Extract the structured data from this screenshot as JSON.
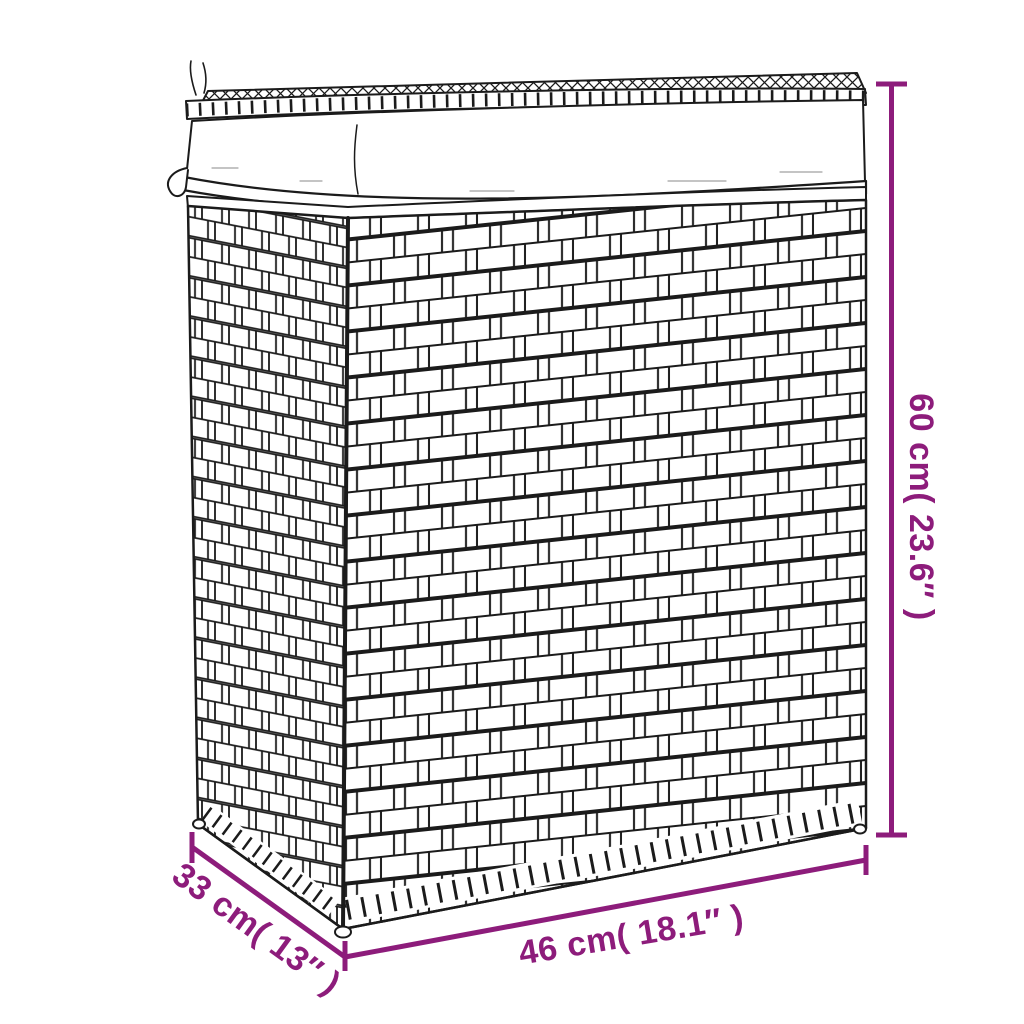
{
  "colors": {
    "accent": "#8d1c7b",
    "line_art": "#1b1b1b",
    "background": "#ffffff"
  },
  "drawing": {
    "subject": "laundry-basket-line-drawing"
  },
  "dimensions": {
    "height": {
      "label": "60 cm( 23.6″ )",
      "value_cm": 60,
      "value_inch": 23.6
    },
    "width": {
      "label": "46 cm( 18.1″ )",
      "value_cm": 46,
      "value_inch": 18.1
    },
    "depth": {
      "label": "33 cm( 13″ )",
      "value_cm": 33,
      "value_inch": 13
    }
  }
}
